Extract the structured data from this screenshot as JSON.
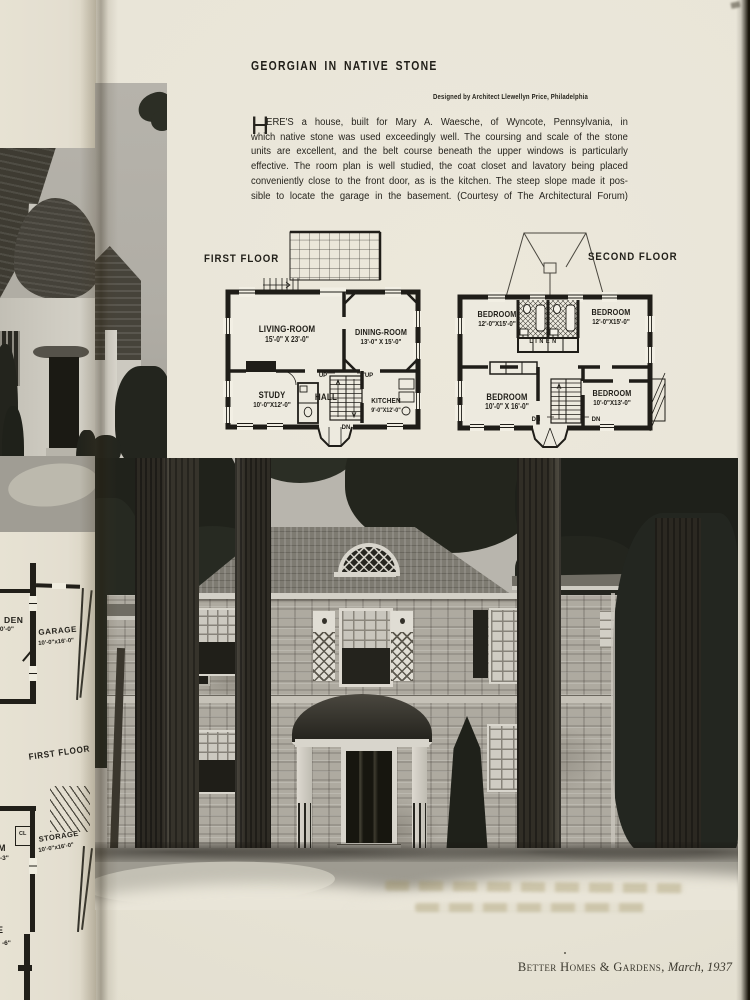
{
  "article": {
    "title": "GEORGIAN IN NATIVE STONE",
    "byline": "Designed by Architect Llewellyn Price, Philadelphia",
    "drop_cap": "H",
    "body_lines": [
      "ERE'S a house, built for Mary A. Waesche, of Wyncote, Pennsylvania, in",
      "which native stone was used exceedingly well. The coursing and scale of the stone",
      "units are excellent, and the belt course beneath the upper windows is particularly",
      "effective. The room plan is well studied, the coat closet and lavatory being placed",
      "conveniently close to the front door, as is the kitchen. The steep slope made it pos-",
      "sible to locate the garage in the basement. (Courtesy of The Architectural Forum)"
    ]
  },
  "plans": {
    "first_floor": {
      "label": "FIRST FLOOR",
      "living": {
        "name": "LIVING-ROOM",
        "dims": "15'-0\" X 23'-0\""
      },
      "dining": {
        "name": "DINING-ROOM",
        "dims": "13'-0\" X 15'-0\""
      },
      "study": {
        "name": "STUDY",
        "dims": "10'-0\"X12'-0\""
      },
      "hall": {
        "name": "HALL"
      },
      "kitchen": {
        "name": "KITCHEN",
        "dims": "9'-0\"X12'-0\""
      },
      "up": "UP",
      "dn": "DN"
    },
    "second_floor": {
      "label": "SECOND FLOOR",
      "bedroom_nw": {
        "name": "BEDROOM",
        "dims": "12'-0\"X15'-0\""
      },
      "bedroom_ne": {
        "name": "BEDROOM",
        "dims": "12'-0\"X15'-0\""
      },
      "linen": {
        "name": "LINEN"
      },
      "bedroom_sw": {
        "name": "BEDROOM",
        "dims": "10'-0\" X 16'-0\""
      },
      "bedroom_se": {
        "name": "BEDROOM",
        "dims": "10'-0\"X13'-0\""
      },
      "dn": "DN"
    }
  },
  "left_page": {
    "den": {
      "name": "DEN",
      "dims": "0\"x10'-0\""
    },
    "garage": {
      "name": "GARAGE",
      "dims": "10'-0\"x16'-0\""
    },
    "floor_label": "FIRST FLOOR",
    "closet": "CL",
    "storage": {
      "name": "STORAGE",
      "dims": "10'-0\"x16'-0\""
    },
    "fragment_room": "M",
    "fragment_room_dims": "-3\"",
    "fragment_room2": "GE",
    "fragment_room2_dims": "-6\""
  },
  "footer": {
    "magazine": "Better Homes & Gardens,",
    "issue": "March, 1937"
  }
}
